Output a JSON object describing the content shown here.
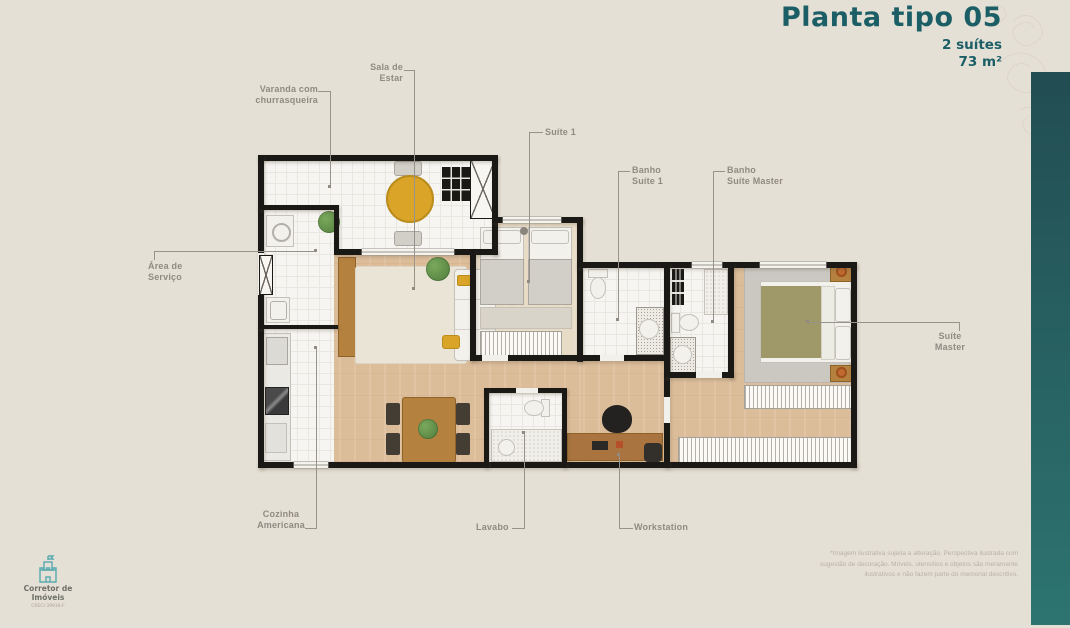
{
  "header": {
    "title": "Planta tipo 05",
    "spec_suites": "2 suítes",
    "spec_area": "73 m²"
  },
  "annotations": {
    "varanda": "Varanda com\nchurrasqueira",
    "sala": "Sala de\nEstar",
    "suite1": "Suíte 1",
    "banho_suite1": "Banho\nSuíte 1",
    "banho_master": "Banho\nSuíte Master",
    "area_servico": "Área de\nServiço",
    "suite_master": "Suíte\nMaster",
    "cozinha": "Cozinha\nAmericana",
    "lavabo": "Lavabo",
    "workstation": "Workstation"
  },
  "footer": {
    "disclaimer": "*Imagem ilustrativa sujeita a alteração. Perspectiva ilustrada com\nsugestão de decoração. Móveis, utensílios e objetos são meramente\nilustrativos e não fazem parte do memorial descritivo.",
    "logo_name": "Corretor de\nImóveis",
    "logo_creci": "CRECI 39916-F"
  },
  "colors": {
    "accent": "#1b5e66",
    "bar_top": "#224d52",
    "bar_bottom": "#2d7470",
    "table_accent": "#d9a427"
  }
}
